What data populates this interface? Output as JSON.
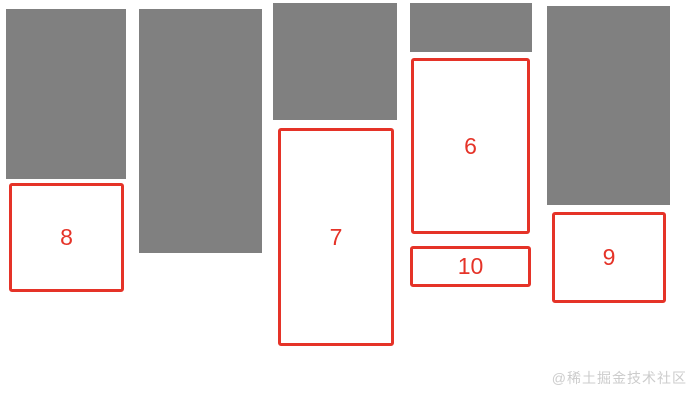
{
  "page": {
    "width": 695,
    "height": 400,
    "background": "#ffffff"
  },
  "palette": {
    "block_gray": "#808080",
    "accent_red": "#e53328",
    "card_background": "#ffffff",
    "watermark_gray": "#cccccc"
  },
  "masonry": {
    "gray_blocks": [
      {
        "x": 6,
        "y": 9,
        "w": 120,
        "h": 170
      },
      {
        "x": 139,
        "y": 9,
        "w": 123,
        "h": 244
      },
      {
        "x": 273,
        "y": 3,
        "w": 124,
        "h": 117
      },
      {
        "x": 410,
        "y": 3,
        "w": 122,
        "h": 49
      },
      {
        "x": 547,
        "y": 6,
        "w": 123,
        "h": 199
      }
    ],
    "numbered_cards": [
      {
        "label": "8",
        "x": 9,
        "y": 183,
        "w": 115,
        "h": 109
      },
      {
        "label": "7",
        "x": 278,
        "y": 128,
        "w": 116,
        "h": 218
      },
      {
        "label": "6",
        "x": 411,
        "y": 58,
        "w": 119,
        "h": 176
      },
      {
        "label": "10",
        "x": 410,
        "y": 246,
        "w": 121,
        "h": 41
      },
      {
        "label": "9",
        "x": 552,
        "y": 212,
        "w": 114,
        "h": 91
      }
    ]
  },
  "watermark": {
    "text": "@稀土掘金技术社区"
  }
}
